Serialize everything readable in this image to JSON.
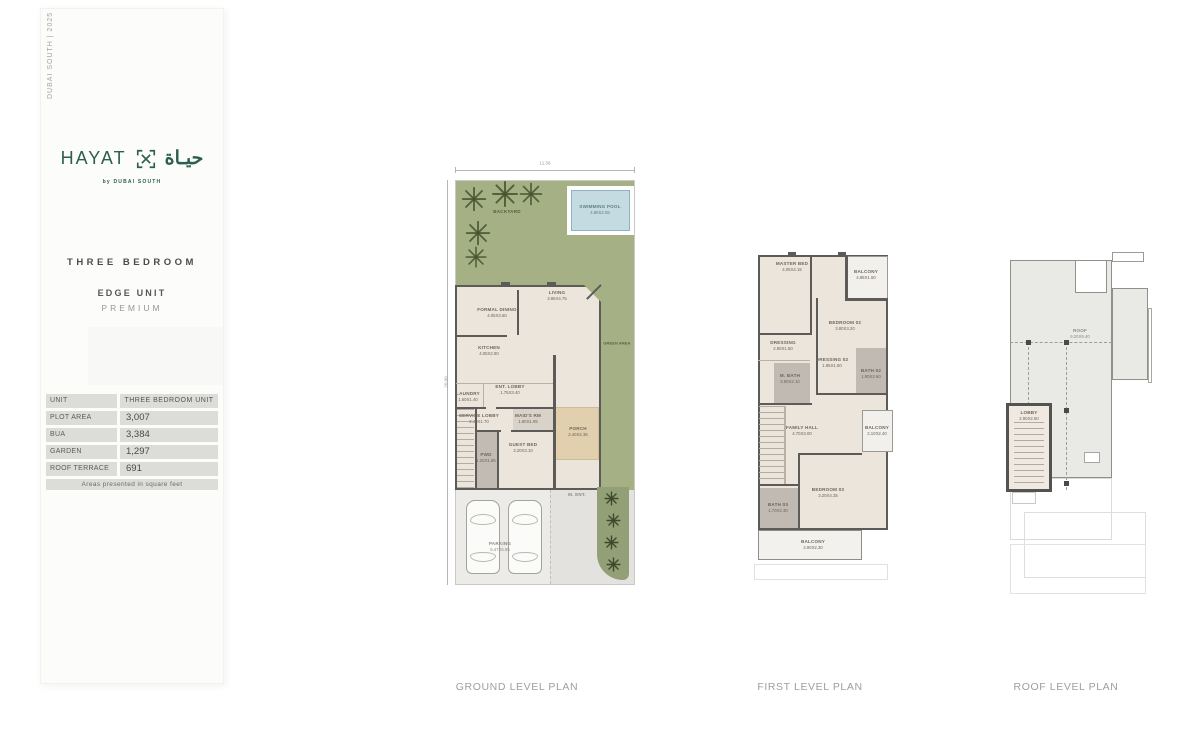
{
  "page": {
    "background": "#ffffff"
  },
  "sidebar": {
    "edition": "DUBAI SOUTH  |  2025",
    "logo": {
      "wordmark": "HAYAT",
      "arabic": "حيـاة",
      "byline": "by DUBAI SOUTH",
      "color": "#2d5f50"
    },
    "unit_type": "THREE BEDROOM",
    "unit_name": "EDGE UNIT",
    "unit_tier": "PREMIUM",
    "table": {
      "rows": [
        {
          "label": "UNIT",
          "value": "THREE BEDROOM UNIT"
        },
        {
          "label": "PLOT AREA",
          "value": "3,007"
        },
        {
          "label": "BUA",
          "value": "3,384"
        },
        {
          "label": "GARDEN",
          "value": "1,297"
        },
        {
          "label": "ROOF TERRACE",
          "value": "691"
        }
      ],
      "footnote": "Areas presented in square feet"
    }
  },
  "plans": {
    "ground": {
      "caption": "GROUND LEVEL PLAN",
      "dim_top": "11.58",
      "dim_left": "20.00",
      "rooms": {
        "backyard": {
          "name": "BACKYARD"
        },
        "pool": {
          "name": "SWIMMING POOL",
          "dim": "4.80X2.55"
        },
        "living": {
          "name": "LIVING",
          "dim": "3.86X4.75"
        },
        "formal_dining": {
          "name": "FORMAL DINING",
          "dim": "4.05X3.60"
        },
        "kitchen": {
          "name": "KITCHEN",
          "dim": "4.05X2.80"
        },
        "laundry": {
          "name": "LAUNDRY",
          "dim": "1.60X1.40"
        },
        "ent_lobby": {
          "name": "ENT. LOBBY",
          "dim": "1.75X3.40"
        },
        "service_lobby": {
          "name": "SERVICE LOBBY",
          "dim": "2.40X1.70"
        },
        "maids_rm": {
          "name": "MAID'S RM",
          "dim": "1.80X1.95"
        },
        "pwd": {
          "name": "PWD",
          "dim": "1.20X1.85"
        },
        "guest_bed": {
          "name": "GUEST BED",
          "dim": "3.20X3.10"
        },
        "porch": {
          "name": "PORCH",
          "dim": "2.40X2.36"
        },
        "green_area": {
          "name": "GREEN AREA"
        },
        "main_ent": {
          "name": "M. ENT."
        },
        "parking": {
          "name": "PARKING",
          "dim": "5.47X5.95"
        }
      }
    },
    "first": {
      "caption": "FIRST LEVEL PLAN",
      "rooms": {
        "master_bed": {
          "name": "MASTER BED",
          "dim": "4.05X4.15"
        },
        "balcony_top": {
          "name": "BALCONY",
          "dim": "4.88X1.50"
        },
        "bedroom_02": {
          "name": "BEDROOM 02",
          "dim": "3.80X3.20"
        },
        "dressing": {
          "name": "DRESSING",
          "dim": "2.80X1.50"
        },
        "master_bath": {
          "name": "M. BATH",
          "dim": "3.80X2.10"
        },
        "dressing_02": {
          "name": "DRESSING 02",
          "dim": "1.85X1.50"
        },
        "bath_02": {
          "name": "BATH 02",
          "dim": "1.90X2.60"
        },
        "balcony_right": {
          "name": "BALCONY",
          "dim": "2.10X2.40"
        },
        "family_hall": {
          "name": "FAMILY HALL",
          "dim": "4.70X3.00"
        },
        "bedroom_03": {
          "name": "BEDROOM 03",
          "dim": "3.20X4.35"
        },
        "bath_03": {
          "name": "BATH 03",
          "dim": "1.70X2.30"
        },
        "balcony_bottom": {
          "name": "BALCONY",
          "dim": "3.90X2.30"
        }
      }
    },
    "roof": {
      "caption": "ROOF LEVEL PLAN",
      "rooms": {
        "roof_terrace": {
          "name": "ROOF",
          "dim": "9.20X9.40"
        },
        "lobby": {
          "name": "LOBBY",
          "dim": "2.90X2.50"
        }
      }
    }
  }
}
